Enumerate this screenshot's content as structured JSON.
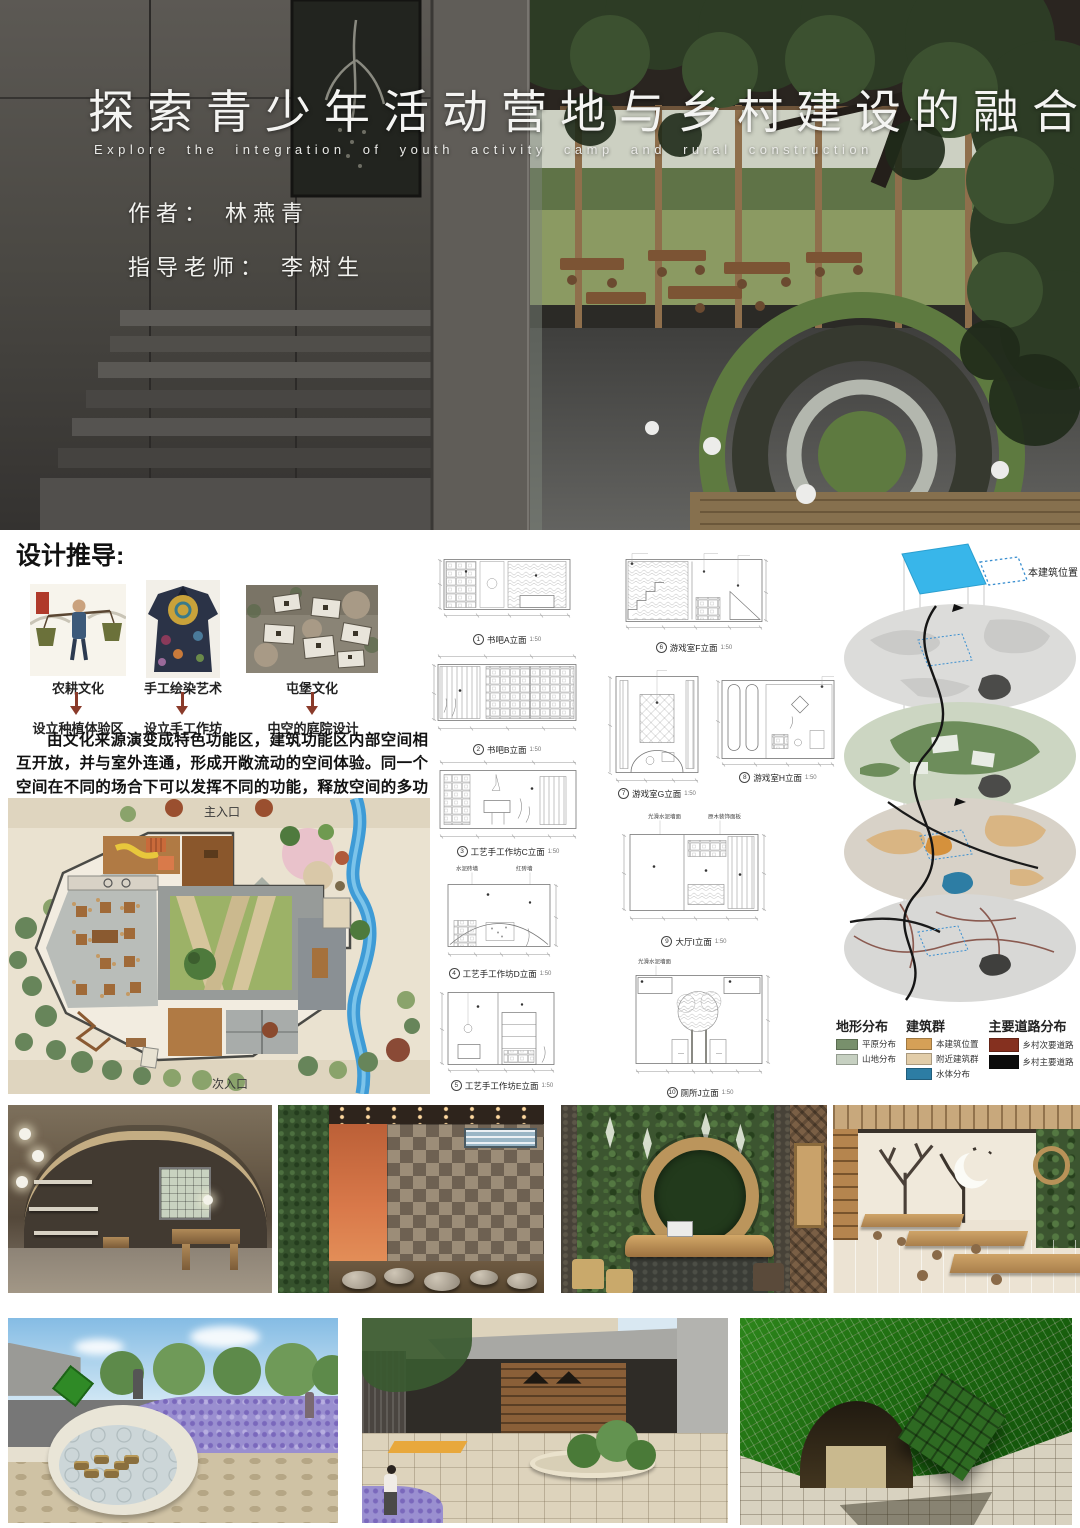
{
  "poster": {
    "title": "探索青少年活动营地与乡村建设的融合",
    "subtitle_en": "Explore the integration of youth activity camp and rural construction",
    "author_label": "作者： 林燕青",
    "advisor_label": "指导老师： 李树生"
  },
  "derivation": {
    "heading": "设计推导:",
    "items": [
      {
        "culture": "农耕文化",
        "result": "设立种植体验区"
      },
      {
        "culture": "手工绘染艺术",
        "result": "设立手工作坊"
      },
      {
        "culture": "屯堡文化",
        "result": "中空的庭院设计"
      }
    ],
    "paragraph": "由文化来源演变成特色功能区，建筑功能区内部空间相互开放，并与室外连通，形成开敞流动的空间体验。同一个空间在不同的场合下可以发挥不同的功能，释放空间的多功能运用。"
  },
  "site_plan": {
    "main_entrance": "主入口",
    "secondary_entrance": "次入口"
  },
  "elevations": [
    {
      "num": "1",
      "name": "书吧A立面",
      "scale": "1:50"
    },
    {
      "num": "2",
      "name": "书吧B立面",
      "scale": "1:50"
    },
    {
      "num": "3",
      "name": "工艺手工作坊C立面",
      "scale": "1:50"
    },
    {
      "num": "4",
      "name": "工艺手工作坊D立面",
      "scale": "1:50",
      "ann1": "水泥砖墙",
      "ann2": "红砖墙"
    },
    {
      "num": "5",
      "name": "工艺手工作坊E立面",
      "scale": "1:50"
    },
    {
      "num": "6",
      "name": "游戏室F立面",
      "scale": "1:50"
    },
    {
      "num": "7",
      "name": "游戏室G立面",
      "scale": "1:50"
    },
    {
      "num": "8",
      "name": "游戏室H立面",
      "scale": "1:50"
    },
    {
      "num": "9",
      "name": "大厅I立面",
      "scale": "1:50",
      "ann1": "光滑水泥墙面",
      "ann2": "原木装饰面板"
    },
    {
      "num": "10",
      "name": "厕所J立面",
      "scale": "1:50",
      "ann1": "光滑水泥墙面"
    }
  ],
  "analysis": {
    "marker_label": "本建筑位置",
    "legend": {
      "terrain": {
        "title": "地形分布",
        "items": [
          {
            "label": "平原分布",
            "color": "#78906c"
          },
          {
            "label": "山地分布",
            "color": "#c6d0c1"
          }
        ]
      },
      "buildings": {
        "title": "建筑群",
        "items": [
          {
            "label": "本建筑位置",
            "color": "#d5a057"
          },
          {
            "label": "附近建筑群",
            "color": "#e2cda9"
          },
          {
            "label": "水体分布",
            "color": "#2d7da4"
          }
        ]
      },
      "roads": {
        "title": "主要道路分布",
        "items": [
          {
            "label": "乡村次要道路",
            "color": "#85301f"
          },
          {
            "label": "乡村主要道路",
            "color": "#0c0c0c"
          }
        ]
      }
    }
  }
}
